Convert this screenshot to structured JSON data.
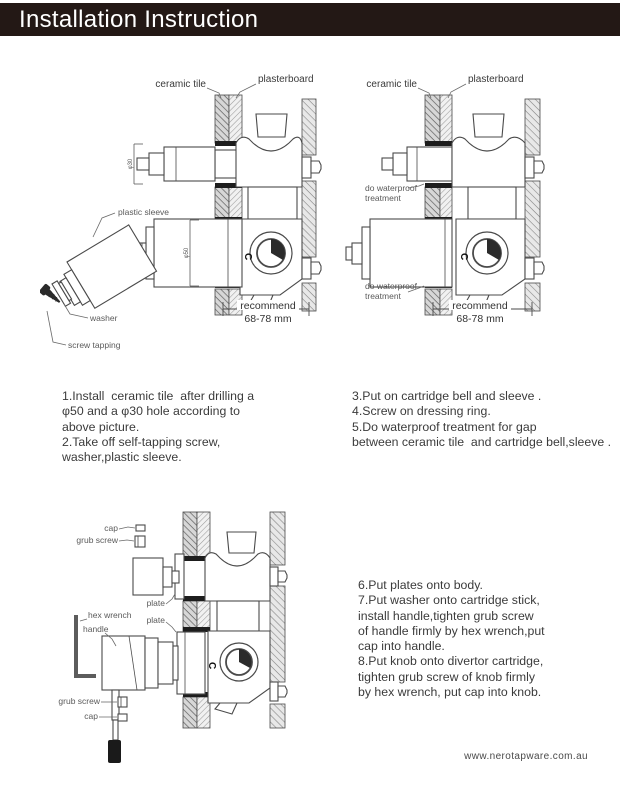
{
  "title_bar": {
    "text": "Installation Instruction",
    "bg": "#231815",
    "fg": "#ffffff"
  },
  "diagram1": {
    "labels": {
      "ceramic_tile": "ceramic tile",
      "plasterboard": "plasterboard",
      "plastic_sleeve": "plastic sleeve",
      "washer": "washer",
      "screw_tapping": "screw tapping",
      "stem_diameter": "φ30",
      "hole_diameter": "φ50",
      "recommend": "recommend",
      "recommend_range": "68-78 mm",
      "cold_mark": "C"
    }
  },
  "diagram2": {
    "labels": {
      "ceramic_tile": "ceramic tile",
      "plasterboard": "plasterboard",
      "waterproof_upper_line1": "do waterproof",
      "waterproof_upper_line2": "treatment",
      "waterproof_lower_line1": "do waterproof",
      "waterproof_lower_line2": "treatment",
      "recommend": "recommend",
      "recommend_range": "68-78 mm",
      "cold_mark": "C"
    }
  },
  "diagram3": {
    "labels": {
      "cap_upper": "cap",
      "grub_screw_upper": "grub screw",
      "hex_wrench": "hex wrench",
      "handle": "handle",
      "plate_upper": "plate",
      "plate_lower": "plate",
      "grub_screw_lower": "grub screw",
      "cap_lower": "cap",
      "cold_mark": "C"
    }
  },
  "instructions": {
    "block1": [
      "1.Install  ceramic tile  after drilling a",
      "φ50 and a φ30 hole according to",
      "above picture.",
      "2.Take off self-tapping screw,",
      "washer,plastic sleeve."
    ],
    "block2": [
      "3.Put on cartridge bell and sleeve .",
      "4.Screw on dressing ring.",
      "5.Do waterproof treatment for gap",
      "between ceramic tile  and cartridge bell,sleeve ."
    ],
    "block3": [
      "6.Put plates onto body.",
      "7.Put washer onto cartridge stick,",
      "install handle,tighten grub screw",
      "of handle firmly by hex wrench,put",
      "cap into handle.",
      "8.Put knob onto divertor cartridge,",
      "tighten grub screw of knob firmly",
      "by hex wrench, put cap into knob."
    ]
  },
  "footer": {
    "website": "www.nerotapware.com.au"
  }
}
